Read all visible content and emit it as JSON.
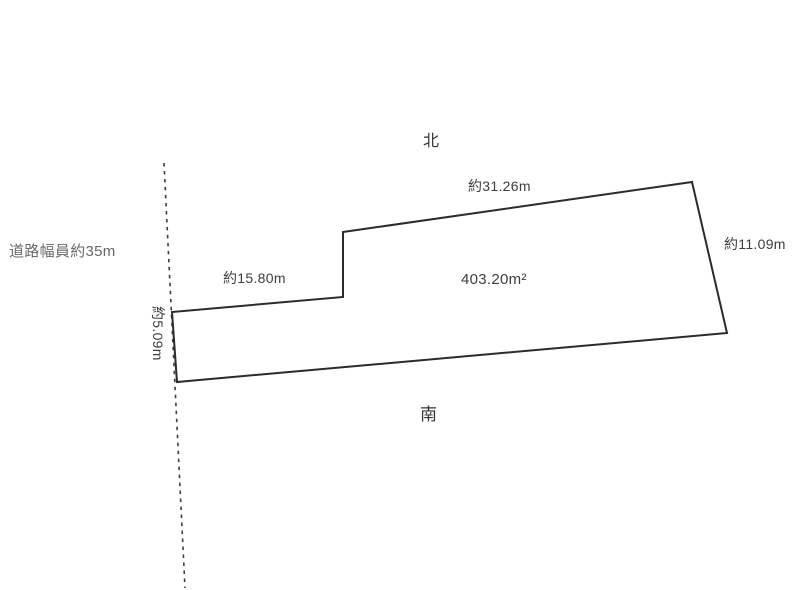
{
  "diagram": {
    "type": "land-plot-survey",
    "compass": {
      "north_label": "北",
      "south_label": "南"
    },
    "road": {
      "label": "道路幅員約35m",
      "line_points": "164,163 185,588"
    },
    "plot": {
      "area_label": "403.20m²",
      "outline_points": "343,232 692,182 727,333 177,382 172,312 343,297",
      "edge_labels": {
        "north_edge": "約31.26m",
        "east_edge": "約11.09m",
        "inner_west_edge": "約15.80m",
        "west_edge": "約5.09m"
      }
    },
    "colors": {
      "outline": "#2b2b2b",
      "road_line": "#3c3c3c",
      "text": "#3d3d3d",
      "road_text": "#686868",
      "background": "#ffffff"
    }
  }
}
